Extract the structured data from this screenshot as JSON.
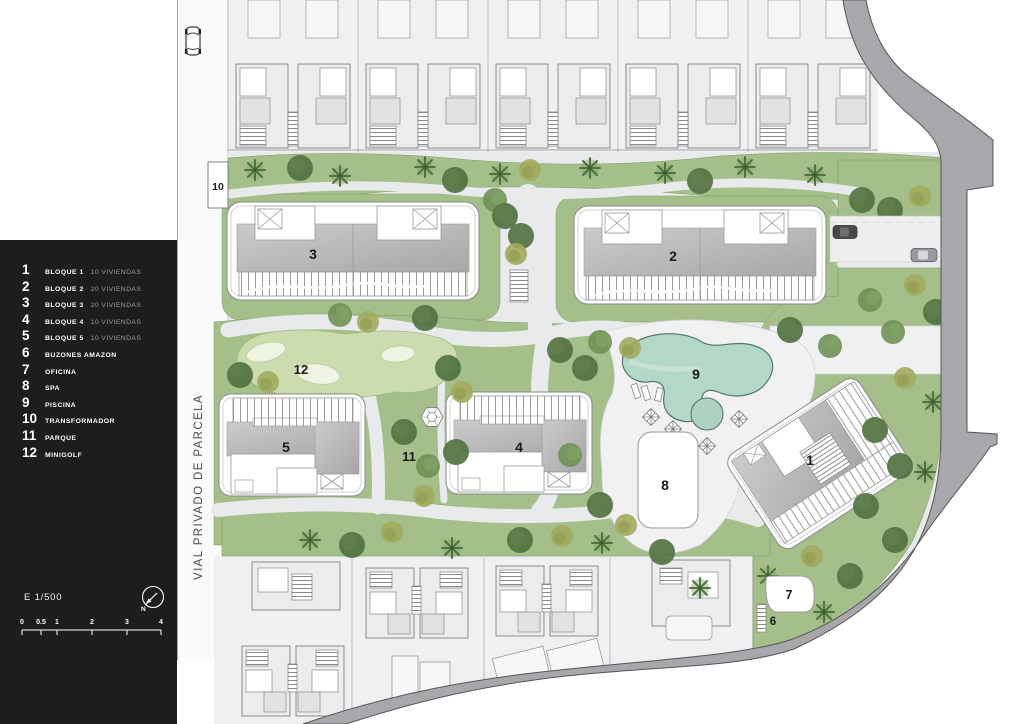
{
  "sidebar": {
    "legend": [
      {
        "num": "1",
        "label": "BLOQUE 1",
        "detail": "10 VIVIENDAS"
      },
      {
        "num": "2",
        "label": "BLOQUE 2",
        "detail": "20 VIVIENDAS"
      },
      {
        "num": "3",
        "label": "BLOQUE 3",
        "detail": "20 VIVIENDAS"
      },
      {
        "num": "4",
        "label": "BLOQUE 4",
        "detail": "10 VIVIENDAS"
      },
      {
        "num": "5",
        "label": "BLOQUE 5",
        "detail": "10 VIVIENDAS"
      },
      {
        "num": "6",
        "label": "BUZONES AMAZON",
        "detail": ""
      },
      {
        "num": "7",
        "label": "OFICINA",
        "detail": ""
      },
      {
        "num": "8",
        "label": "SPA",
        "detail": ""
      },
      {
        "num": "9",
        "label": "PISCINA",
        "detail": ""
      },
      {
        "num": "10",
        "label": "TRANSFORMADOR",
        "detail": ""
      },
      {
        "num": "11",
        "label": "PARQUE",
        "detail": ""
      },
      {
        "num": "12",
        "label": "MINIGOLF",
        "detail": ""
      }
    ],
    "scale_text": "E 1/500",
    "north_label": "N",
    "scale_ticks": [
      "0",
      "0.5",
      "1",
      "2",
      "3",
      "4"
    ]
  },
  "plan": {
    "street_label": "VIAL PRIVADO DE PARCELA",
    "labels": {
      "block1": "1",
      "block2": "2",
      "block3": "3",
      "block4": "4",
      "block5": "5",
      "mailboxes": "6",
      "office": "7",
      "spa": "8",
      "pool": "9",
      "transformer": "10",
      "park": "11",
      "minigolf": "12"
    }
  },
  "colors": {
    "sidebar_bg": "#1d1d1d",
    "legend_text": "#ffffff",
    "legend_muted": "#9b9b9b",
    "lawn": "#a5bf8a",
    "lawn_light": "#b7cb9b",
    "tree_dark": "#527242",
    "tree_mid": "#6f9155",
    "tree_olive": "#a2aa5e",
    "minigolf_green": "#ccdcae",
    "pool_water": "#b4d8c8",
    "pool_edge": "#55756a",
    "path": "#e9eaec",
    "deck": "#f1f1f3",
    "road_perimeter": "#a8a8ac",
    "road_edge": "#565656",
    "building_fill": "#ffffff",
    "building_roof": "#b9b9bb",
    "neighbor_bg": "#f0f0f1"
  }
}
